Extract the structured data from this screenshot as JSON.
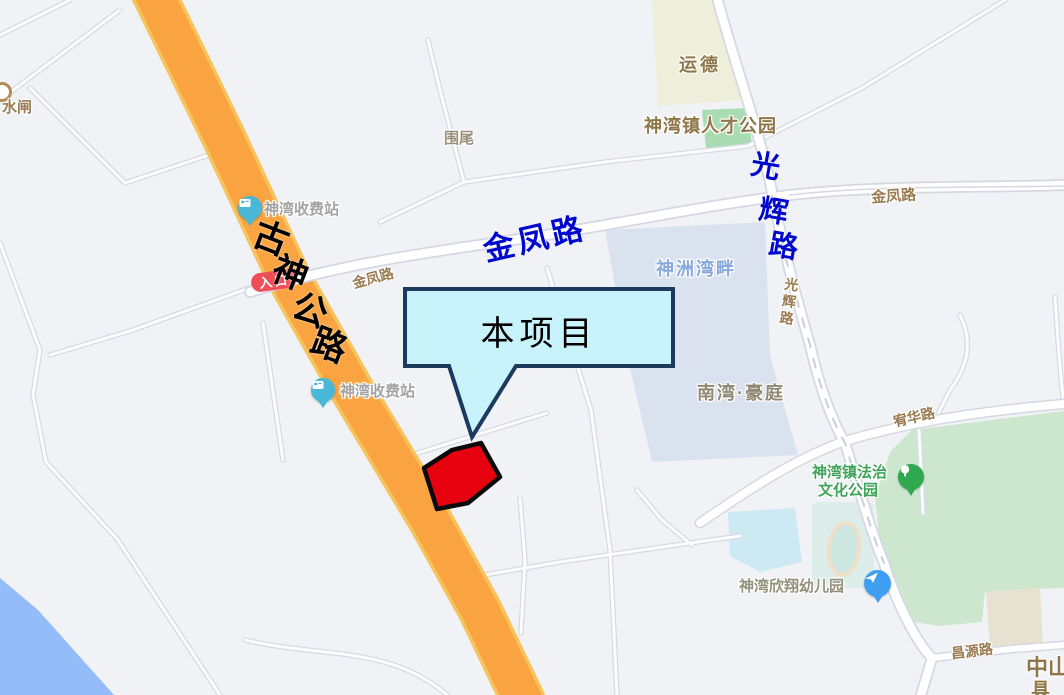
{
  "map": {
    "labels": {
      "shuizha": "水闸",
      "weiwei": "围尾",
      "yunde": "运德",
      "rencai_park": "神湾镇人才公园",
      "toll_north": "神湾收费站",
      "toll_south": "神湾收费站",
      "entrance_badge": "入口",
      "jinfeng_road_west": "金凤路",
      "jinfeng_road_east": "金凤路",
      "guanghui_road": "光辉路",
      "shenzhou_wanpan": "神洲湾畔",
      "nanwan_haoting": "南湾·豪庭",
      "fazhi_park_line1": "神湾镇法治",
      "fazhi_park_line2": "文化公园",
      "kindergarten": "神湾欣翔幼儿园",
      "changyuan_road": "昌源路",
      "youhua_road": "宥华路",
      "zhongshan": "中山",
      "zhongshan_partial": "具"
    },
    "icons": {
      "toll_north": "toll-station-pin",
      "toll_south": "toll-station-pin",
      "kindergarten": "kindergarten-pin",
      "fazhi_park": "park-pin",
      "shuizha": "water-gate-icon"
    }
  },
  "annotations": {
    "gushen_highway": {
      "text": "古神公路",
      "chars": [
        "古",
        "神",
        "公",
        "路"
      ],
      "color": "#000000"
    },
    "jinfeng_blue": {
      "text": "金凤路",
      "color": "#0008CE"
    },
    "guanghui_blue": {
      "text": "光辉路",
      "chars": [
        "光",
        "辉",
        "路"
      ],
      "color": "#0008CE"
    },
    "callout": {
      "label": "本项目",
      "fill": "#C9F3FB",
      "border": "#1C3A5E"
    },
    "site_polygon": {
      "fill": "#E7000E",
      "border": "#0A0A0A"
    }
  },
  "colors": {
    "map_background": "#F0F2F6",
    "highway_fill": "#F9A440",
    "highway_edge": "#F6C35C",
    "road_fill": "#FFFFFF",
    "road_casing": "#D5D8E2",
    "park_green": "#CDE7CF",
    "park_patch_green": "#A9DCB2",
    "yunde_block": "#EDEFDA",
    "water_blue": "#93BCF8",
    "pond_blue": "#CDE9F3",
    "block_gray_blue": "#DBE2EF",
    "beige_block": "#E7E1D2",
    "annotation_blue": "#0008CE",
    "callout_fill": "#C9F3FB",
    "callout_border": "#1C3A5E",
    "site_red": "#E7000E",
    "entrance_red": "#EF4E59",
    "toll_pin": "#49B7D7",
    "kindergarten_pin": "#3D9EF2",
    "park_pin": "#2FA850",
    "label_brown": "#9A7B50",
    "label_green": "#3FA35A",
    "label_blue": "#87A9DC"
  }
}
